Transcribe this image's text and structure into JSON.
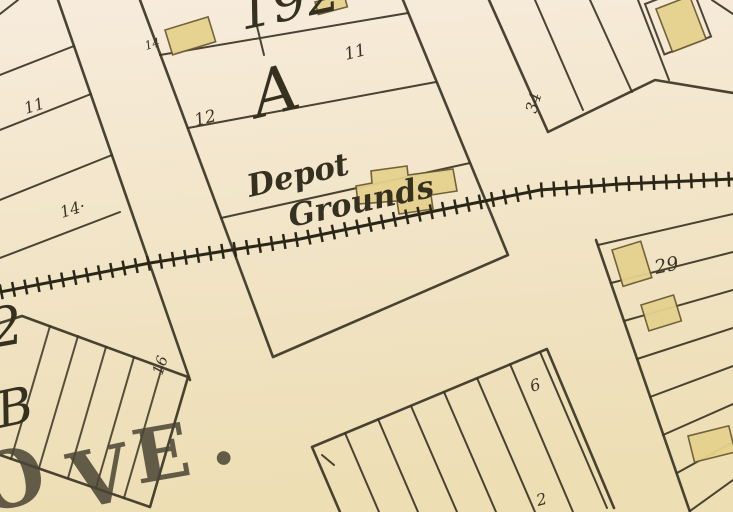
{
  "map": {
    "labels": {
      "block_number_top": "192",
      "block_letter_center": "A",
      "block_letter_left": "B",
      "depot_grounds_line1": "Depot",
      "depot_grounds_line2": "Grounds",
      "street_letter_o": "O",
      "street_letter_v": "V",
      "street_letter_e": "E",
      "street_period": ".",
      "partial_numeral_left": "2"
    },
    "lot_numbers": {
      "left_block_11": "11",
      "left_block_14": "14·",
      "center_block_14": "14",
      "center_block_12": "12",
      "center_block_11": "11",
      "ne_block_34": "34",
      "strip_block_29": "29",
      "hatched_block_16": "16",
      "bottom_block_6": "6",
      "bottom_block_2": "2"
    },
    "palette": {
      "paper_top": "#f7ecdc",
      "paper_mid": "#f2e5c9",
      "paper_bottom": "#eddeb4",
      "ink": "#3a3425",
      "rail": "#2b2718",
      "building_fill": "#e6d28e",
      "building_stroke": "#6b5c33"
    }
  }
}
